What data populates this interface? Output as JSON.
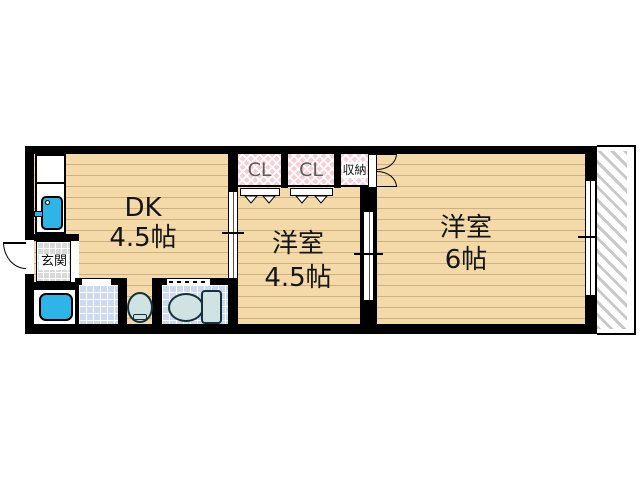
{
  "floorplan": {
    "title": "2DK apartment floor plan",
    "rooms": [
      {
        "name": "DK",
        "size": "4.5帖"
      },
      {
        "name": "洋室",
        "size": "4.5帖"
      },
      {
        "name": "洋室",
        "size": "6帖"
      }
    ],
    "closets": [
      {
        "label": "CL"
      },
      {
        "label": "CL"
      },
      {
        "label": "収納"
      }
    ],
    "entrance": {
      "label": "玄関"
    },
    "fixtures": [
      "kitchen-sink",
      "bathtub",
      "wash-basin",
      "toilet"
    ],
    "colors": {
      "wall": "#000000",
      "floor": "#f4d9a9",
      "floor_line": "#cdb183",
      "closet_pink": "#f6ced6",
      "tile_blue": "#ccd9ee",
      "fixture_blue": "#2db5e8",
      "ceramic": "#cfe3e3",
      "entrance_tile": "#d9d9d9",
      "balcony_hatch": "#c9c9c9"
    }
  }
}
